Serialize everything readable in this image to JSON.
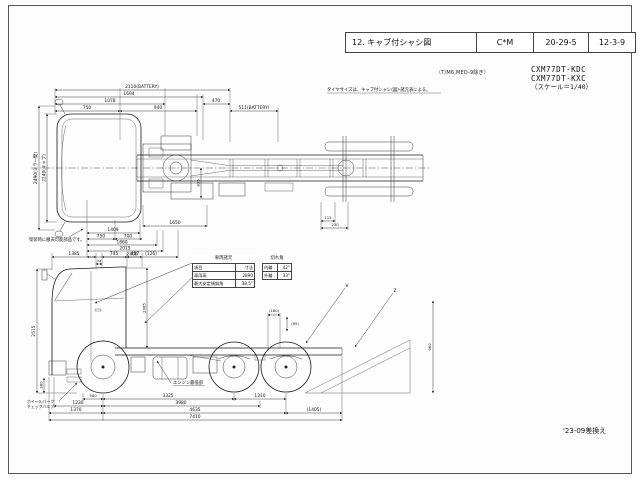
{
  "title_block": {
    "label": "12. キャブ付シャシ図",
    "col2": "C*M",
    "col3": "20-29-5",
    "col4": "12-3-9"
  },
  "header": {
    "tm_note": "（T/M6,MED-9除き）",
    "model1": "CXM77DT-KDC",
    "model2": "CXM77DT-KXC",
    "scale": "（スケール＝1/40）"
  },
  "revision": "'23-09差換え",
  "top_view": {
    "tire_note": "タイヤサイズは、キャブ付シャシ(図)-諸元表による。",
    "removal_note": "架装時に撤去可能部品です。",
    "dims_top": [
      "2110(BATTERY)",
      "1694",
      "1078",
      "750",
      "940",
      "470",
      "511(BATTERY)"
    ],
    "dims_left": [
      "2490(ミラー間)",
      "2240(キャブ)"
    ],
    "dims_bottom": [
      "1650",
      "115",
      "230",
      "1409",
      "750",
      "700",
      "1860",
      "2015",
      "2400"
    ],
    "dim_mid": "835"
  },
  "side_view": {
    "dims_top": [
      "1385",
      "74",
      "745",
      "457",
      "(126)"
    ],
    "dims_left": [
      "2515",
      "380"
    ],
    "dim_cab_rear": "2085",
    "dims_rear": [
      "(180)",
      "(95)",
      "960"
    ],
    "leader_letters": [
      "V",
      "Z"
    ],
    "dims_bottom": [
      "500",
      "3325",
      "1310",
      "1230",
      "3980",
      "1370",
      "4635",
      "(1405)",
      "7410"
    ],
    "engine_note": "エンジン最低部",
    "valve_note_line1": "ホイールパーク",
    "valve_note_line2": "チェックバルブ"
  },
  "spec_table": {
    "title": "車両諸元",
    "header_item": "項目",
    "header_val": "寸法",
    "rows": [
      {
        "label": "車両高",
        "value": "2890"
      },
      {
        "label": "最大安定傾斜角",
        "value": "38.5°"
      }
    ]
  },
  "steer_table": {
    "title": "切れ角",
    "rows": [
      {
        "label": "内輪",
        "value": "42°"
      },
      {
        "label": "外輪",
        "value": "33°"
      }
    ]
  }
}
